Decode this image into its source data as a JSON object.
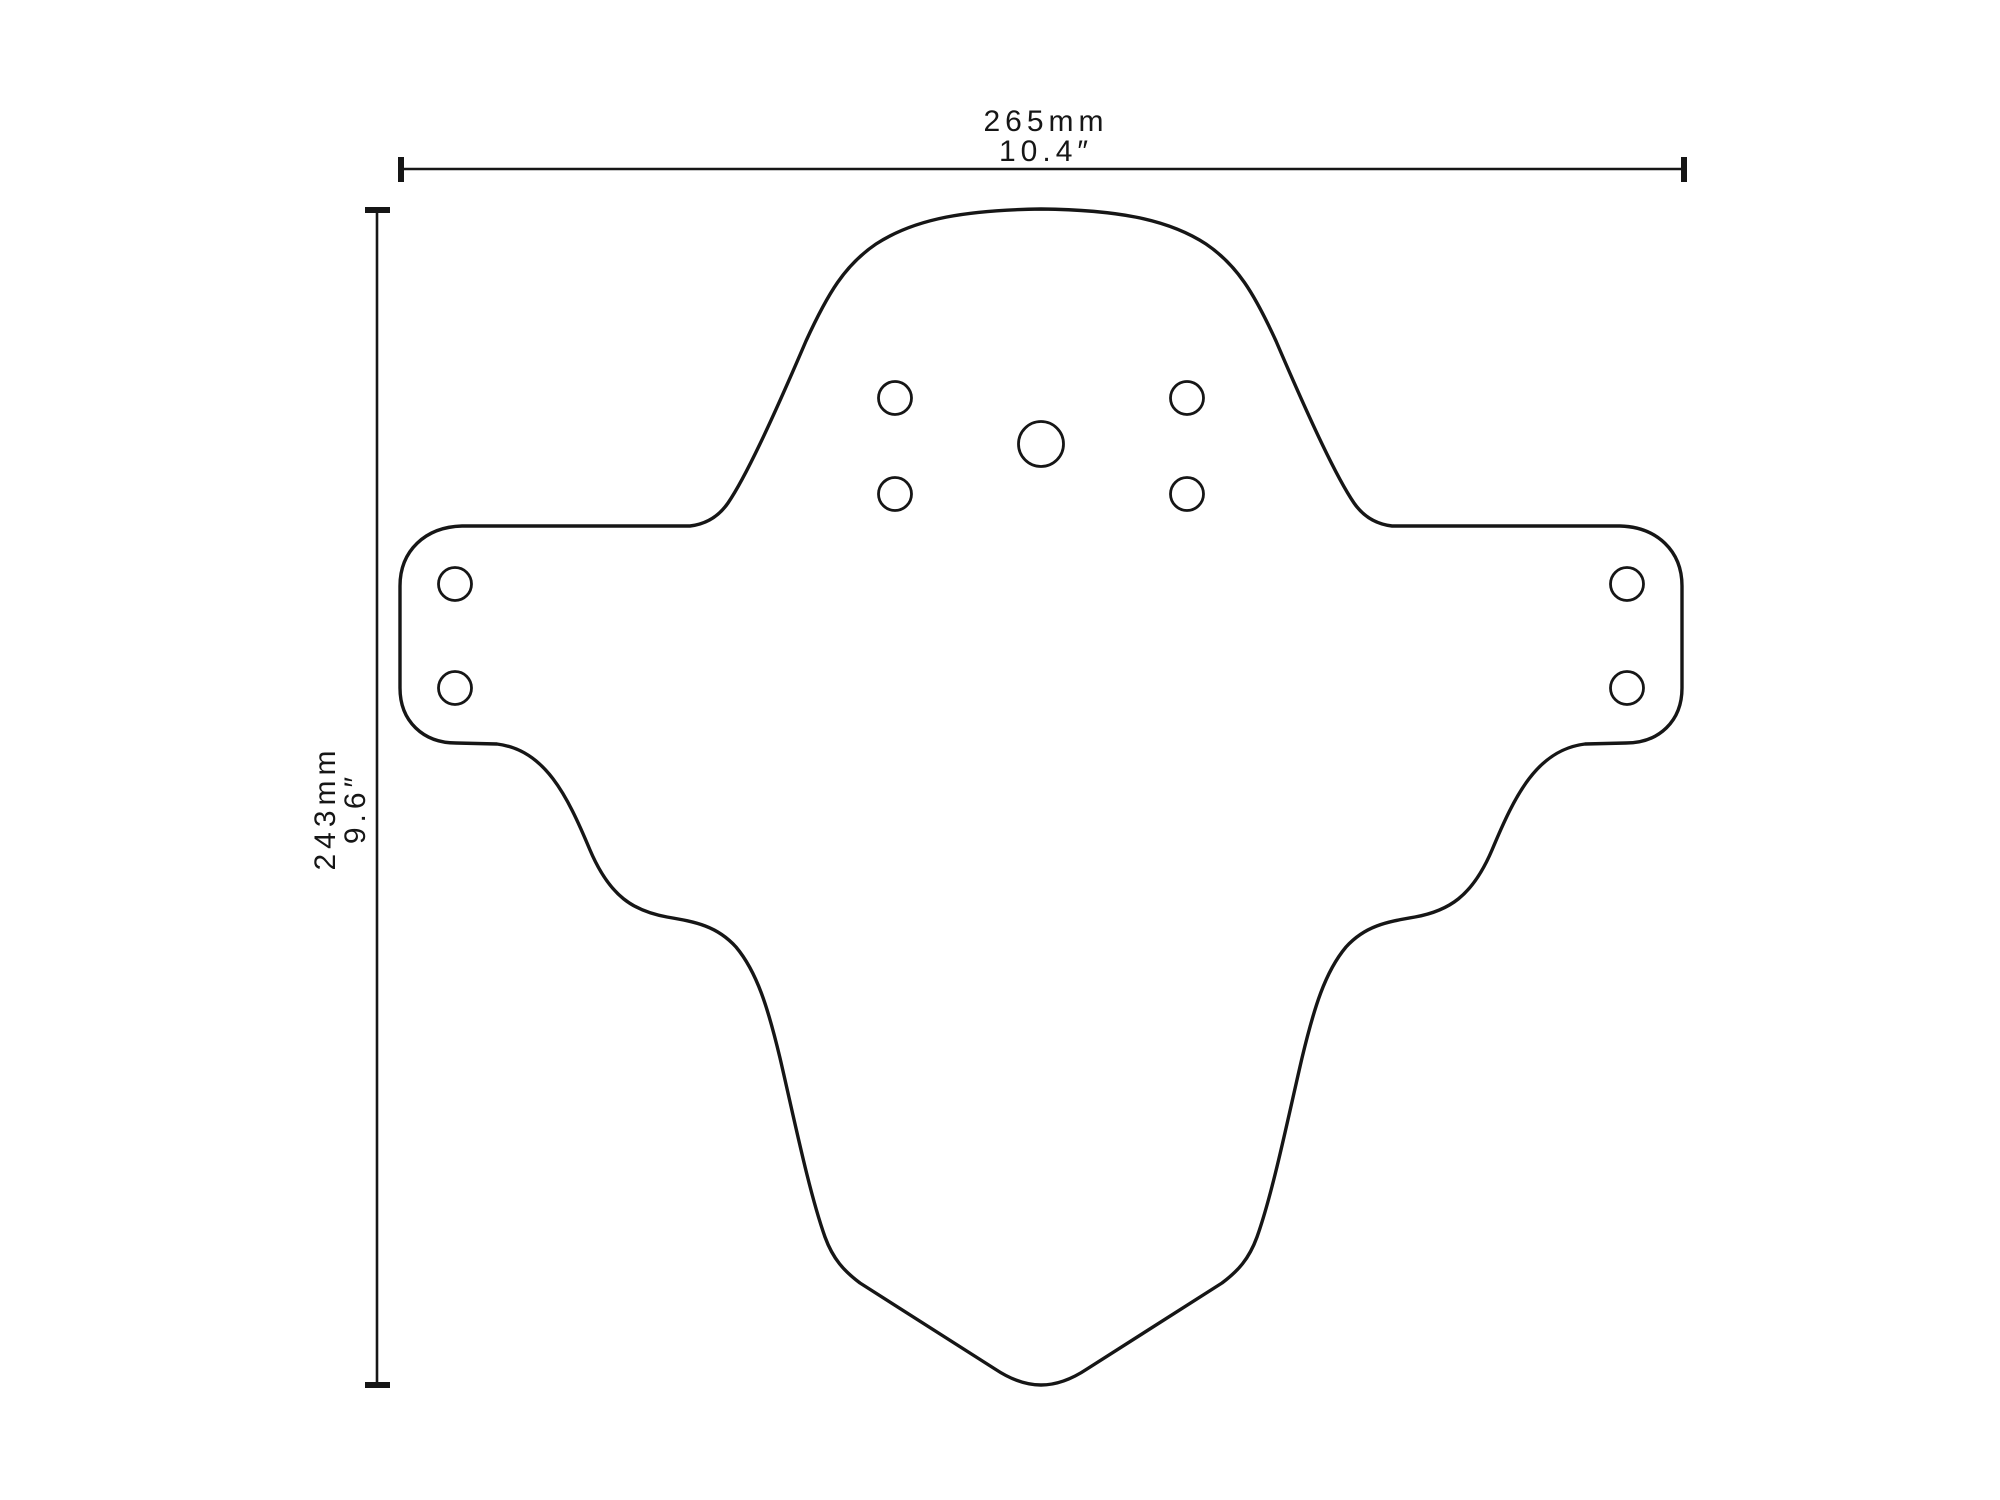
{
  "page": {
    "background": "#ffffff",
    "ink_color": "#161616",
    "description": "Technical outline drawing of a mudguard (fender) template with overall width and height dimensions"
  },
  "dimensions": {
    "width": {
      "metric": "265mm",
      "imperial": "10.4″"
    },
    "height": {
      "metric": "243mm",
      "imperial": "9.6″"
    }
  },
  "drawing": {
    "viewbox": "0 0 2000 1500",
    "stroke": "#161616",
    "elements": [
      {
        "name": "width-dimension-line",
        "type": "line",
        "attrs": {
          "x1": 400,
          "y1": 169,
          "x2": 1685,
          "y2": 169,
          "stroke-width": 2.6
        }
      },
      {
        "name": "width-dimension-tick-left",
        "type": "line",
        "attrs": {
          "x1": 401,
          "y1": 157,
          "x2": 401,
          "y2": 182,
          "stroke-width": 6
        }
      },
      {
        "name": "width-dimension-tick-right",
        "type": "line",
        "attrs": {
          "x1": 1684,
          "y1": 157,
          "x2": 1684,
          "y2": 182,
          "stroke-width": 6
        }
      },
      {
        "name": "height-dimension-line",
        "type": "line",
        "attrs": {
          "x1": 377,
          "y1": 210,
          "x2": 377,
          "y2": 1385,
          "stroke-width": 2.6
        }
      },
      {
        "name": "height-dimension-tick-top",
        "type": "line",
        "attrs": {
          "x1": 365,
          "y1": 210,
          "x2": 390,
          "y2": 210,
          "stroke-width": 6
        }
      },
      {
        "name": "height-dimension-tick-bottom",
        "type": "line",
        "attrs": {
          "x1": 365,
          "y1": 1385,
          "x2": 390,
          "y2": 1385,
          "stroke-width": 6
        }
      },
      {
        "name": "mudguard-outline",
        "type": "path",
        "attrs": {
          "stroke-width": 3.4,
          "stroke-linejoin": "round",
          "d": "M 1041 209 C 968 210 916 218 876 244 C 845 265 828 293 806 341 C 770 425 745 478 728 503 C 719 516 707 524 690 526 L 462 526 C 425 527 400 551 400 586 L 400 688 C 400 721 423 743 456 743 L 497 744 C 545 750 567 795 590 850 C 610 897 634 911 667 917 C 696 922 717 926 736 947 C 757 972 768 1008 780 1058 C 794 1118 809 1192 825 1237 C 833 1259 844 1271 860 1283 L 995 1369 C 1010 1379 1025 1385 1041 1385 C 1057 1385 1072 1379 1087 1369 L 1222 1283 C 1238 1271 1249 1259 1257 1237 C 1273 1192 1288 1118 1302 1058 C 1314 1008 1325 972 1346 947 C 1365 926 1386 922 1415 917 C 1448 911 1472 897 1492 850 C 1515 795 1537 750 1585 744 L 1626 743 C 1659 743 1682 721 1682 688 L 1682 586 C 1682 551 1657 527 1620 526 L 1392 526 C 1375 524 1363 516 1354 503 C 1337 478 1312 425 1276 341 C 1254 293 1237 265 1206 244 C 1166 218 1114 210 1041 209 Z"
        }
      },
      {
        "name": "center-mount-hole",
        "type": "circle",
        "attrs": {
          "cx": 1041,
          "cy": 444,
          "r": 22.5,
          "stroke-width": 2.8
        }
      },
      {
        "name": "mount-hole-top-left",
        "type": "circle",
        "attrs": {
          "cx": 895,
          "cy": 398,
          "r": 16.5,
          "stroke-width": 2.8
        }
      },
      {
        "name": "mount-hole-top-right",
        "type": "circle",
        "attrs": {
          "cx": 1187,
          "cy": 398,
          "r": 16.5,
          "stroke-width": 2.8
        }
      },
      {
        "name": "mount-hole-bottom-left",
        "type": "circle",
        "attrs": {
          "cx": 895,
          "cy": 494,
          "r": 16.5,
          "stroke-width": 2.8
        }
      },
      {
        "name": "mount-hole-bottom-right",
        "type": "circle",
        "attrs": {
          "cx": 1187,
          "cy": 494,
          "r": 16.5,
          "stroke-width": 2.8
        }
      },
      {
        "name": "wing-hole-left-upper",
        "type": "circle",
        "attrs": {
          "cx": 455,
          "cy": 584,
          "r": 16.5,
          "stroke-width": 2.8
        }
      },
      {
        "name": "wing-hole-left-lower",
        "type": "circle",
        "attrs": {
          "cx": 455,
          "cy": 688,
          "r": 16.5,
          "stroke-width": 2.8
        }
      },
      {
        "name": "wing-hole-right-upper",
        "type": "circle",
        "attrs": {
          "cx": 1627,
          "cy": 584,
          "r": 16.5,
          "stroke-width": 2.8
        }
      },
      {
        "name": "wing-hole-right-lower",
        "type": "circle",
        "attrs": {
          "cx": 1627,
          "cy": 688,
          "r": 16.5,
          "stroke-width": 2.8
        }
      }
    ]
  }
}
